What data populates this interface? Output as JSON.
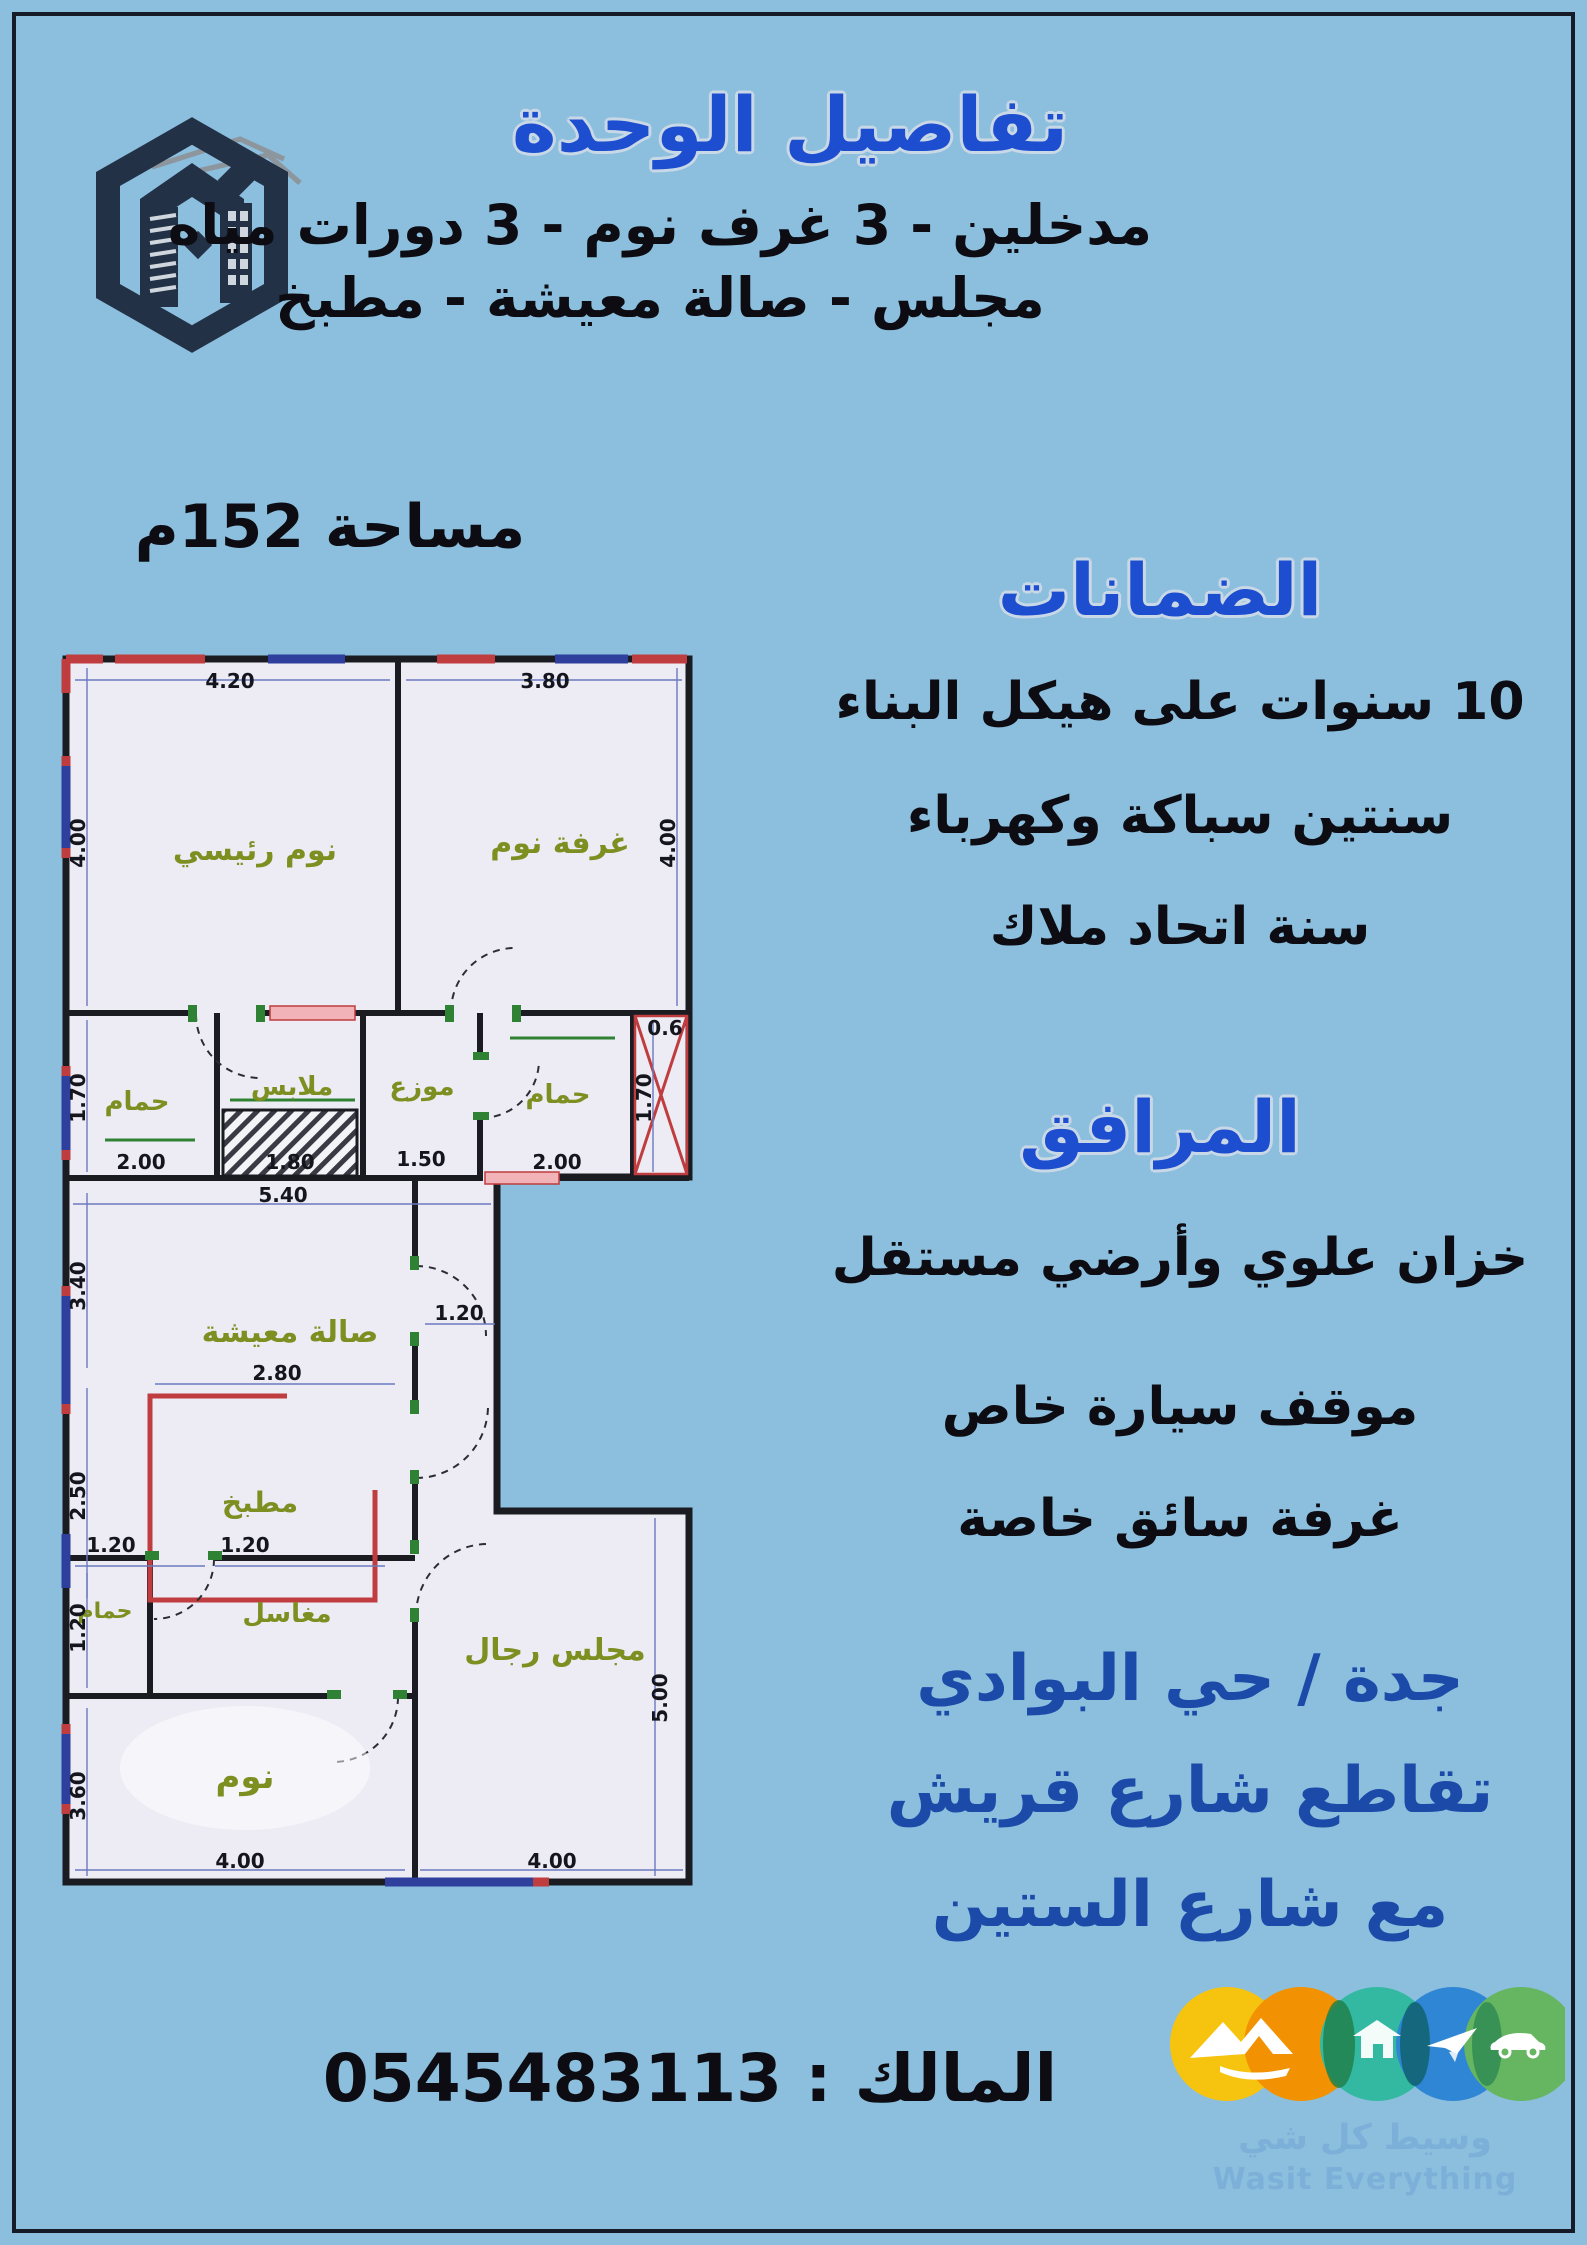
{
  "page": {
    "background": "#8cbedd",
    "frame_color": "#151c28"
  },
  "header": {
    "title": "تفاصيل الوحدة",
    "line1": "مدخلين - 3 غرف نوم - 3 دورات مياه",
    "line2": "مجلس - صالة معيشة - مطبخ",
    "area": "مساحة 152م"
  },
  "warranties": {
    "heading": "الضمانات",
    "items": [
      "10 سنوات على هيكل البناء",
      "سنتين سباكة وكهرباء",
      "سنة اتحاد ملاك"
    ]
  },
  "facilities": {
    "heading": "المرافق",
    "items": [
      "خزان علوي وأرضي مستقل",
      "موقف سيارة خاص",
      "غرفة سائق خاصة"
    ]
  },
  "location": {
    "lines": [
      "جدة / حي البوادي",
      "تقاطع شارع قريش",
      "مع شارع الستين"
    ],
    "color": "#1b4aa8"
  },
  "contact": {
    "label": "المالك :",
    "phone": "0545483113"
  },
  "brand": {
    "name_ar": "وسيط كل شي",
    "name_en": "Wasit Everything",
    "circle_colors": [
      "#f6c40e",
      "#f29202",
      "#33b9a2",
      "#2e86d4",
      "#66b561"
    ]
  },
  "plan": {
    "paper_color": "#edecf4",
    "wall_color": "#1b1b22",
    "accent_red": "#c03d3f",
    "accent_blue": "#2e3f9e",
    "accent_green": "#2f8233",
    "rooms": [
      {
        "id": "master-bedroom",
        "label": "نوم رئيسي",
        "x": 200,
        "y": 212,
        "size": 30
      },
      {
        "id": "bedroom",
        "label": "غرفة نوم",
        "x": 505,
        "y": 205,
        "size": 30
      },
      {
        "id": "bath-1",
        "label": "حمام",
        "x": 82,
        "y": 462,
        "size": 26
      },
      {
        "id": "closet",
        "label": "ملابس",
        "x": 237,
        "y": 447,
        "size": 26
      },
      {
        "id": "hall",
        "label": "موزع",
        "x": 367,
        "y": 447,
        "size": 26
      },
      {
        "id": "bath-2",
        "label": "حمام",
        "x": 503,
        "y": 455,
        "size": 26
      },
      {
        "id": "living-room",
        "label": "صالة معيشة",
        "x": 235,
        "y": 694,
        "size": 30
      },
      {
        "id": "kitchen",
        "label": "مطبخ",
        "x": 205,
        "y": 864,
        "size": 28
      },
      {
        "id": "bath-3",
        "label": "حمام",
        "x": 50,
        "y": 970,
        "size": 22
      },
      {
        "id": "sinks",
        "label": "مغاسل",
        "x": 232,
        "y": 974,
        "size": 26
      },
      {
        "id": "bedroom-2",
        "label": "نوم",
        "x": 190,
        "y": 1140,
        "size": 34,
        "fill": "#a4bc42"
      },
      {
        "id": "majlis",
        "label": "مجلس رجال",
        "x": 500,
        "y": 1012,
        "size": 30
      }
    ],
    "dims": [
      {
        "v": "4.20",
        "x": 175,
        "y": 40
      },
      {
        "v": "3.80",
        "x": 490,
        "y": 40
      },
      {
        "v": "4.00",
        "x": 30,
        "y": 195,
        "rot": -90
      },
      {
        "v": "4.00",
        "x": 620,
        "y": 195,
        "rot": -90
      },
      {
        "v": "1.70",
        "x": 30,
        "y": 450,
        "rot": -90
      },
      {
        "v": "2.00",
        "x": 86,
        "y": 521
      },
      {
        "v": "1.80",
        "x": 235,
        "y": 521
      },
      {
        "v": "1.50",
        "x": 366,
        "y": 518
      },
      {
        "v": "2.00",
        "x": 502,
        "y": 521
      },
      {
        "v": "1.70",
        "x": 596,
        "y": 450,
        "rot": -90
      },
      {
        "v": "0.6",
        "x": 610,
        "y": 387
      },
      {
        "v": "5.40",
        "x": 228,
        "y": 554
      },
      {
        "v": "3.40",
        "x": 30,
        "y": 638,
        "rot": -90
      },
      {
        "v": "2.80",
        "x": 222,
        "y": 732
      },
      {
        "v": "2.50",
        "x": 30,
        "y": 848,
        "rot": -90
      },
      {
        "v": "1.20",
        "x": 404,
        "y": 672
      },
      {
        "v": "1.20",
        "x": 56,
        "y": 904
      },
      {
        "v": "1.20",
        "x": 190,
        "y": 904
      },
      {
        "v": "1.20",
        "x": 30,
        "y": 980,
        "rot": -90
      },
      {
        "v": "3.60",
        "x": 30,
        "y": 1148,
        "rot": -90
      },
      {
        "v": "4.00",
        "x": 185,
        "y": 1220
      },
      {
        "v": "4.00",
        "x": 497,
        "y": 1220
      },
      {
        "v": "5.00",
        "x": 612,
        "y": 1050,
        "rot": -90
      }
    ]
  }
}
